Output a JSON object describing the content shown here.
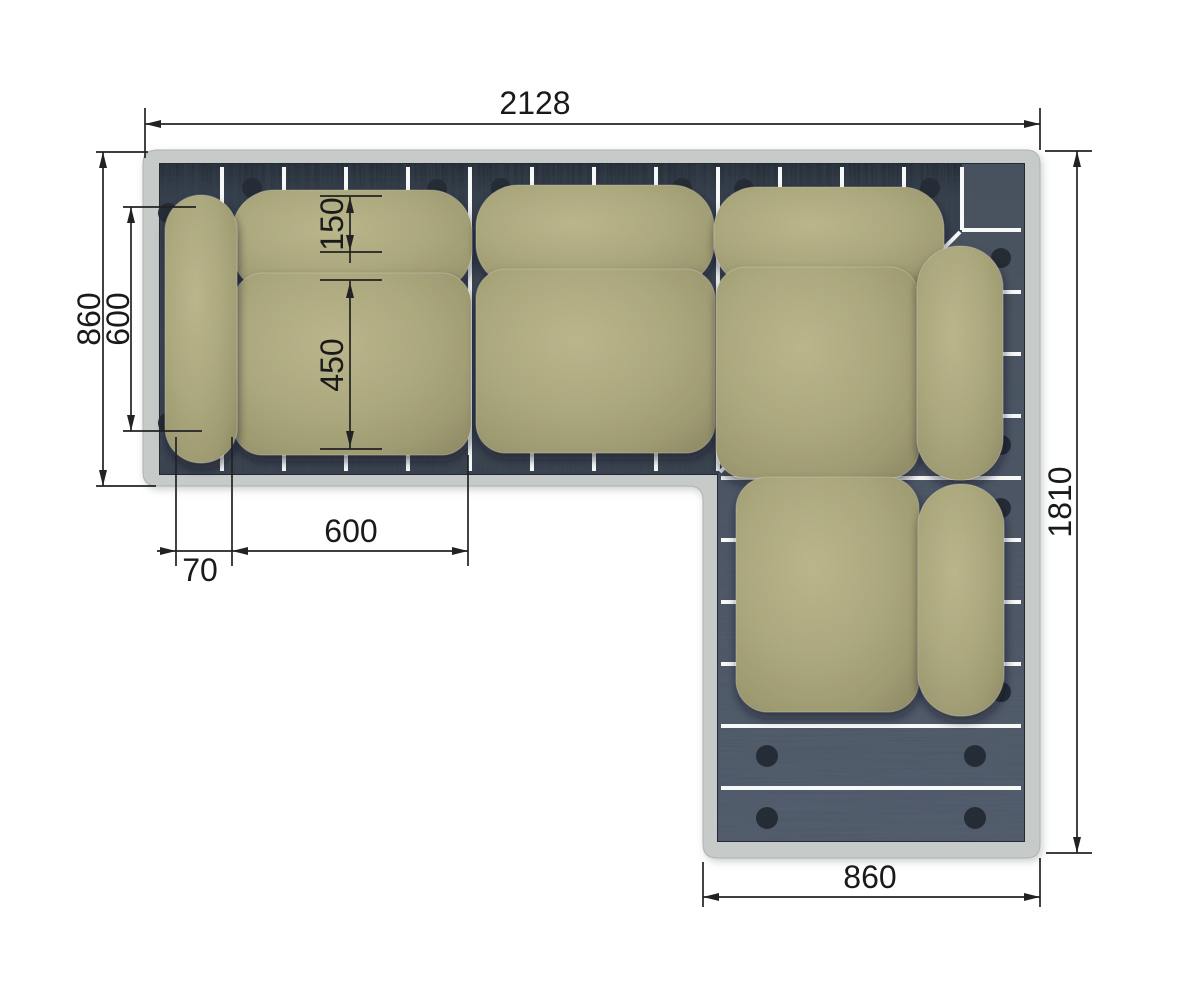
{
  "dimensions": {
    "overall_width": "2128",
    "side_depth": "860",
    "backrest_span": "600",
    "backrest_depth": "150",
    "seat_depth": "450",
    "seat_width": "600",
    "armrest_width": "70",
    "chaise_length": "1810",
    "chaise_width": "860"
  },
  "colors": {
    "background": "#ffffff",
    "frame": "#c6cac9",
    "deck_dark": "#39414d",
    "deck_light": "#535d6a",
    "slat_gap": "#f7f9f8",
    "cushion": "#aeaa7d",
    "bolt": "#252c35",
    "dimension_line": "#222222",
    "dimension_text": "#1a1a1a"
  }
}
